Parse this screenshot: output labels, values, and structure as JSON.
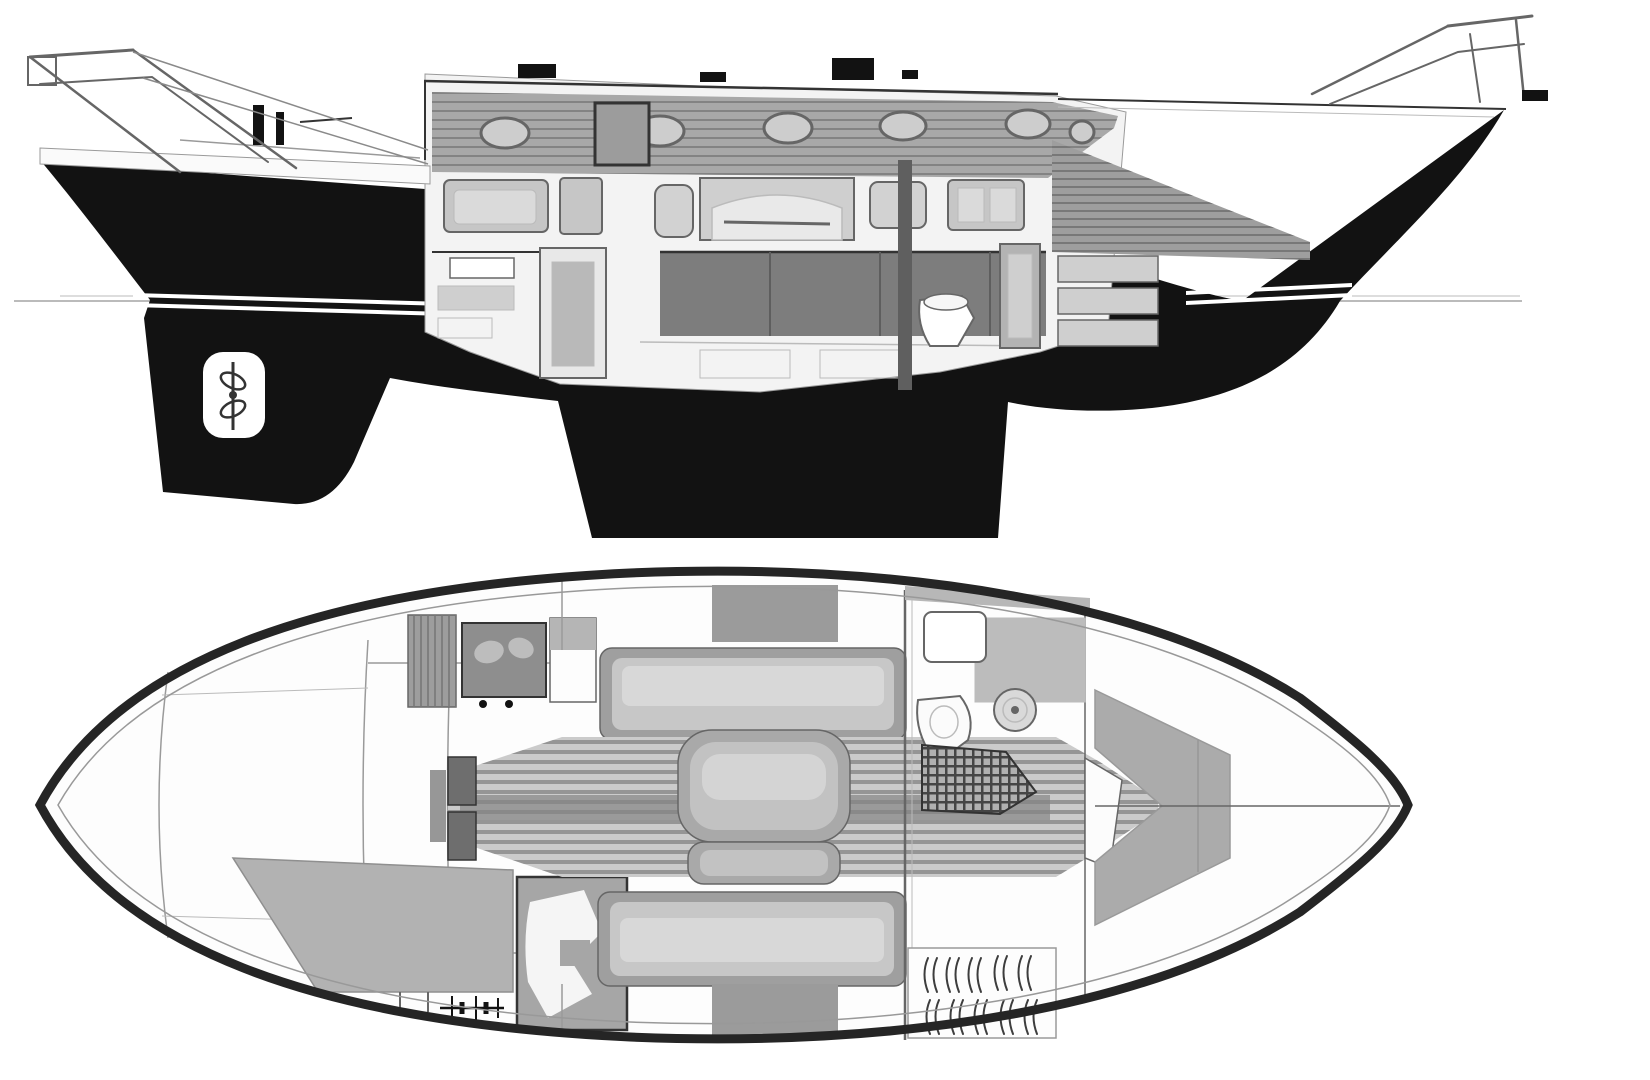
{
  "canvas": {
    "width": 1650,
    "height": 1080,
    "background": "#ffffff"
  },
  "palette": {
    "ink": "#121212",
    "stroke-dark": "#333333",
    "stroke-mid": "#666666",
    "stroke-light": "#9a9a9a",
    "hairline": "#bbbbbb",
    "panel-bg": "#f3f3f3",
    "wood": "#a8a8a8",
    "wood-fwd": "#9e9e9e",
    "locker": "#c6c6c6",
    "door-panel": "#b9b9b9",
    "cushion-dark": "#7d7d7d",
    "engine": "#6f6f6f",
    "drawer": "#cfcfcf",
    "berth-gray": "#b2b2b2",
    "nav-gray": "#a6a6a6",
    "screen-gray": "#8e8e8e",
    "blob-light": "#bdbdbd",
    "col-cap": "#b5b5b5",
    "settee-rim": "#9f9f9f",
    "settee-mid": "#c7c7c7",
    "settee-core": "#d8d8d8",
    "sole-light": "#cbcbcb",
    "sole-dark": "#8c8c8c",
    "sole-center": "#858585",
    "table-rim": "#a9a9a9",
    "table-mid": "#c2c2c2",
    "table-core": "#d4d4d4",
    "grate-base": "#b0b0b0",
    "grate-line": "#454545",
    "sink-gray": "#d9d9d9",
    "side-deck": "#b7b7b7",
    "v-berth": "#ababab",
    "white": "#ffffff"
  },
  "profile_view": {
    "label": "sailboat-profile-cutaway",
    "portholes": [
      {
        "cx": 505,
        "cy": 133,
        "rx": 24,
        "ry": 15
      },
      {
        "cx": 660,
        "cy": 131,
        "rx": 24,
        "ry": 15
      },
      {
        "cx": 788,
        "cy": 128,
        "rx": 24,
        "ry": 15
      },
      {
        "cx": 903,
        "cy": 126,
        "rx": 23,
        "ry": 14
      },
      {
        "cx": 1028,
        "cy": 124,
        "rx": 22,
        "ry": 14
      },
      {
        "cx": 1082,
        "cy": 132,
        "rx": 12,
        "ry": 11
      }
    ],
    "features": [
      "stern-pulpit",
      "lifelines",
      "cockpit-pedestal",
      "coachroof-hatches",
      "companionway-door",
      "saloon-settee",
      "galley-lockers",
      "arched-alcove",
      "engine-box",
      "head-toilet",
      "head-door",
      "forward-drawers",
      "mast-post",
      "bow-wood-panel",
      "keel",
      "skeg",
      "rudder",
      "propeller-aperture",
      "boot-stripe",
      "waterline",
      "bow-pulpit",
      "anchor-fitting"
    ]
  },
  "plan_view": {
    "label": "sailboat-deck-plan",
    "hanger_marks": [
      {
        "x": 928,
        "y": 958
      },
      {
        "x": 950,
        "y": 958
      },
      {
        "x": 972,
        "y": 958
      },
      {
        "x": 998,
        "y": 956
      },
      {
        "x": 1022,
        "y": 956
      },
      {
        "x": 930,
        "y": 1000
      },
      {
        "x": 954,
        "y": 1000
      },
      {
        "x": 978,
        "y": 1000
      },
      {
        "x": 1004,
        "y": 1000
      },
      {
        "x": 1028,
        "y": 1000
      }
    ],
    "features": [
      "hull-outline",
      "deck-inner-line",
      "centerline",
      "cockpit-well",
      "aft-double-berth",
      "chart-counter",
      "battery-symbol",
      "breaker-panel",
      "stove",
      "galley-column",
      "port-settee",
      "starboard-settee",
      "saloon-table",
      "cabin-sole",
      "mast-step",
      "main-bulkhead",
      "head-vanity",
      "deck-hatch",
      "sink",
      "toilet",
      "shower-grating",
      "head-door",
      "hanging-locker",
      "v-berth",
      "side-deck-band"
    ]
  }
}
